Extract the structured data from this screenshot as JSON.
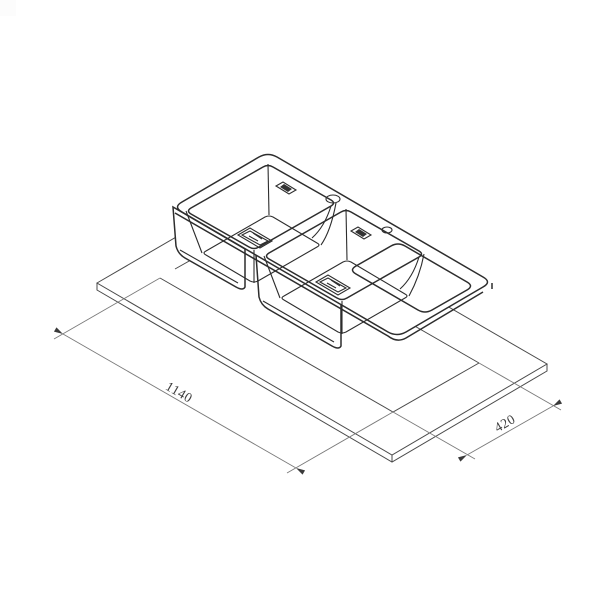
{
  "drawing": {
    "title": "isometric-sink-installation-diagram",
    "dimensions": {
      "length": {
        "value": "1140"
      },
      "width": {
        "value": "420"
      }
    },
    "parts": {
      "countertop": "worktop panel with rectangular cutout",
      "sink": "double bowl inset sink with drainer board",
      "left_bowl": "square bowl with waste drain",
      "right_bowl": "square bowl with waste drain",
      "drainer": "flat drainer board",
      "tap_holes": "2 round faucet holes",
      "overflow_slots": "2 overflow slots"
    },
    "colors": {
      "background": "#ffffff",
      "sink_stroke": "#2d2d2d",
      "counter_stroke": "#4a4a4a",
      "dimension_stroke": "#7a7a7a",
      "dimension_text": "#3f3f3f"
    }
  }
}
